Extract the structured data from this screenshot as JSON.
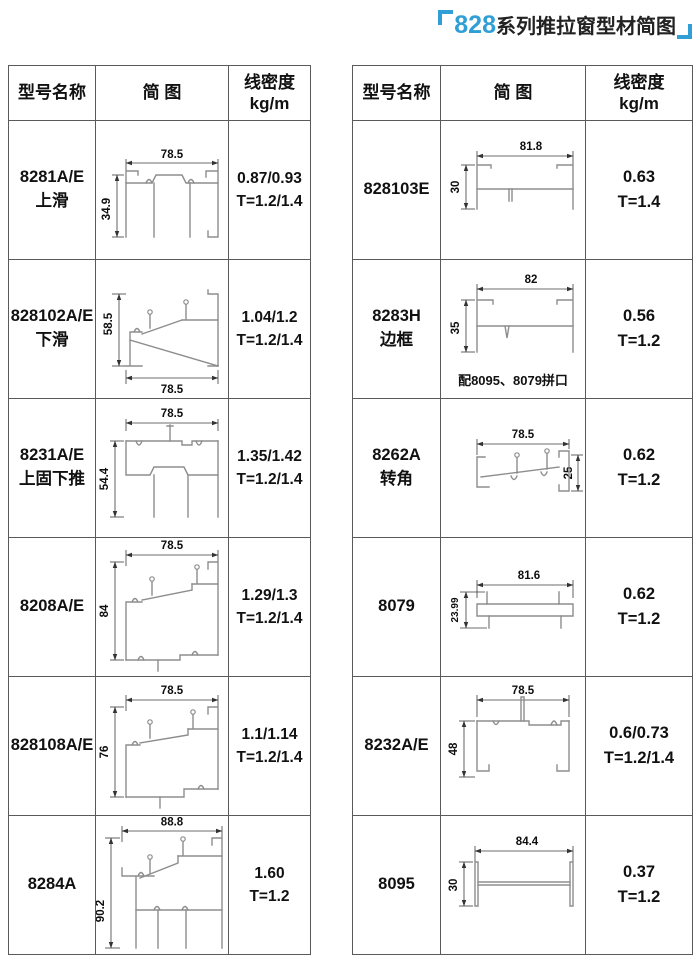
{
  "title": {
    "series": "828",
    "text": "系列推拉窗型材简图",
    "accent_color": "#2f9fd6"
  },
  "header": {
    "model": "型号名称",
    "diagram": "简 图",
    "density": "线密度",
    "unit": "kg/m"
  },
  "left": {
    "rows": [
      {
        "model": "8281A/E",
        "sub": "上滑",
        "w": "78.5",
        "h": "34.9",
        "density": "0.87/0.93",
        "thickness": "T=1.2/1.4"
      },
      {
        "model": "828102A/E",
        "sub": "下滑",
        "w": "78.5",
        "h": "58.5",
        "density": "1.04/1.2",
        "thickness": "T=1.2/1.4"
      },
      {
        "model": "8231A/E",
        "sub": "上固下推",
        "w": "78.5",
        "h": "54.4",
        "density": "1.35/1.42",
        "thickness": "T=1.2/1.4"
      },
      {
        "model": "8208A/E",
        "sub": "",
        "w": "78.5",
        "h": "84",
        "density": "1.29/1.3",
        "thickness": "T=1.2/1.4"
      },
      {
        "model": "828108A/E",
        "sub": "",
        "w": "78.5",
        "h": "76",
        "density": "1.1/1.14",
        "thickness": "T=1.2/1.4"
      },
      {
        "model": "8284A",
        "sub": "",
        "w": "88.8",
        "h": "90.2",
        "density": "1.60",
        "thickness": "T=1.2"
      }
    ]
  },
  "right": {
    "rows": [
      {
        "model": "828103E",
        "sub": "",
        "w": "81.8",
        "h": "30",
        "density": "0.63",
        "thickness": "T=1.4",
        "note": ""
      },
      {
        "model": "8283H",
        "sub": "边框",
        "w": "82",
        "h": "35",
        "density": "0.56",
        "thickness": "T=1.2",
        "note": "配8095、8079拼口"
      },
      {
        "model": "8262A",
        "sub": "转角",
        "w": "78.5",
        "h": "25",
        "density": "0.62",
        "thickness": "T=1.2",
        "note": ""
      },
      {
        "model": "8079",
        "sub": "",
        "w": "81.6",
        "h": "23.99",
        "density": "0.62",
        "thickness": "T=1.2",
        "note": ""
      },
      {
        "model": "8232A/E",
        "sub": "",
        "w": "78.5",
        "h": "48",
        "density": "0.6/0.73",
        "thickness": "T=1.2/1.4",
        "note": ""
      },
      {
        "model": "8095",
        "sub": "",
        "w": "84.4",
        "h": "30",
        "density": "0.37",
        "thickness": "T=1.2",
        "note": ""
      }
    ]
  }
}
